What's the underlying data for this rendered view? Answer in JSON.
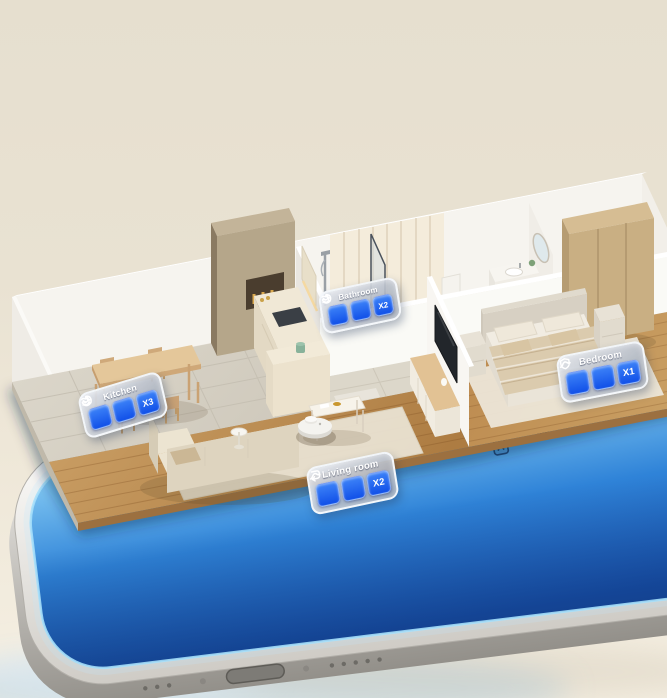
{
  "badges": [
    {
      "id": "kitchen",
      "title": "Kitchen",
      "icons": [
        "suction-swirl-icon",
        "mop-waves-icon"
      ],
      "multiplier": "X3"
    },
    {
      "id": "bathroom",
      "title": "Bathroom",
      "icons": [
        "suction-swirl-icon",
        "mop-waves-icon"
      ],
      "multiplier": "X2"
    },
    {
      "id": "bedroom",
      "title": "Bedroom",
      "icons": [
        "shield-icon",
        "route-curve-icon"
      ],
      "multiplier": "X1"
    },
    {
      "id": "living_room",
      "title": "Living room",
      "icons": [
        "loop-arrow-icon",
        "route-curve-icon"
      ],
      "multiplier": "X2"
    }
  ],
  "colors": {
    "badge_tile_blue": "#1f5cee",
    "badge_glass_silver": "#aeb6c2",
    "phone_screen_blue": "#2f83d8",
    "wood_floor": "#c08d52",
    "walls": "#f6f4ef",
    "background": "#e9e2d2"
  }
}
